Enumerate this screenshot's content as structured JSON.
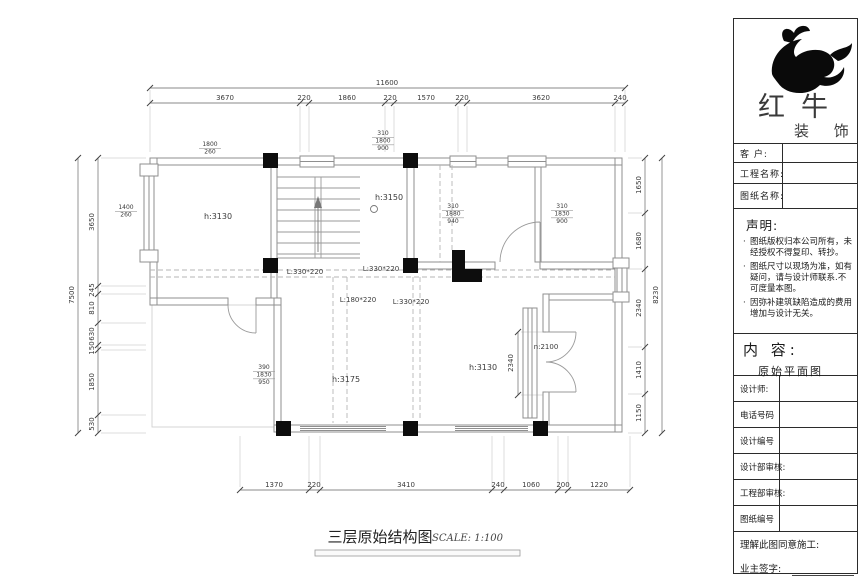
{
  "brand": {
    "name_main": "红牛",
    "name_sub": "装 饰",
    "logo_icon": "bull-swoosh"
  },
  "title_block": {
    "customer_label": "客  户:",
    "project_label": "工程名称:",
    "drawing_label": "图纸名称:",
    "statement": {
      "heading": "声明:",
      "items": [
        "图纸版权归本公司所有，未经授权不得复印、转抄。",
        "图纸尺寸以现场为准，如有疑问，请与设计师联系.不可度量本图。",
        "因弥补建筑缺陷造成的费用增加与设计无关。"
      ]
    },
    "content": {
      "heading": "内 容:",
      "value": "原始平面图"
    },
    "designer_label": "设计师:",
    "phone_label": "电话号码",
    "design_no_label": "设计编号",
    "design_review_label": "设计部审核:",
    "engineering_review_label": "工程部审核:",
    "drawing_no_label": "图纸编号",
    "agreement_label": "理解此图同意施工:",
    "signature_label": "业主签字:"
  },
  "drawing": {
    "caption": {
      "title": "三层原始结构图",
      "scale": "SCALE: 1:100"
    },
    "rooms": {
      "left": "h:3130",
      "stair": "h:3150",
      "bottom_left": "h:3175",
      "bottom_right": "h:3130",
      "niche": "n:2100"
    },
    "beams": {
      "b1": "L:330*220",
      "b2": "L:330*220",
      "b3": "L:180*220",
      "b4": "L:330*220"
    },
    "callouts": {
      "stair_top": [
        "310",
        "1800",
        "900"
      ],
      "right_a": [
        "310",
        "1880",
        "940"
      ],
      "right_b": [
        "310",
        "1830",
        "900"
      ],
      "left_top": [
        "1800",
        "260"
      ],
      "left_mid": [
        "1400",
        "260"
      ],
      "bottom_left": [
        "390",
        "1830",
        "950"
      ]
    },
    "dims": {
      "top_total": "11600",
      "top": [
        "3670",
        "220",
        "1860",
        "220",
        "1570",
        "220",
        "3620",
        "240"
      ],
      "left_total": "7500",
      "left": [
        "3650",
        "245",
        "810",
        "630",
        "150",
        "1850",
        "530"
      ],
      "right_total": "8230",
      "right": [
        "1650",
        "1680",
        "2340",
        "1410",
        "1150"
      ],
      "bottom": [
        "1370",
        "220",
        "3410",
        "240",
        "1060",
        "200",
        "1220"
      ],
      "door": "2340"
    }
  }
}
